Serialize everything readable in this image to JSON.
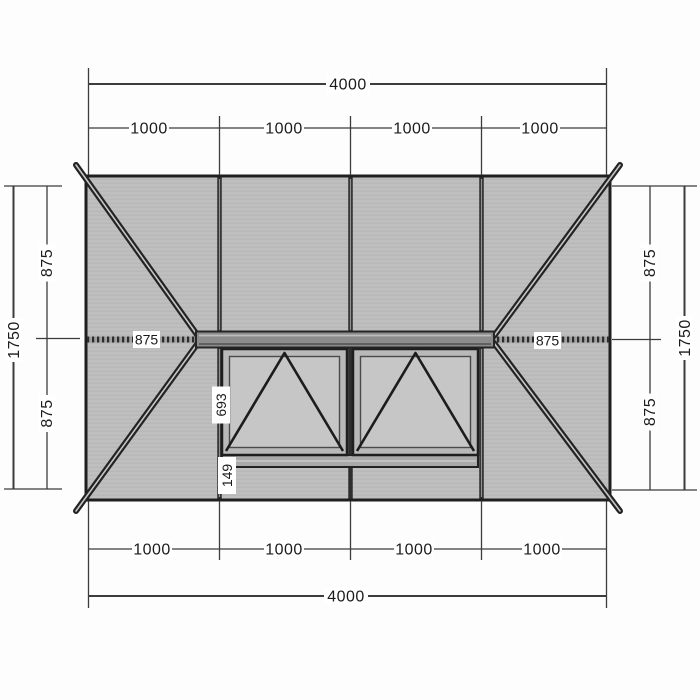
{
  "drawing": {
    "title": "roof-lantern-plan",
    "colors": {
      "roof_glass": "#bfbfbf",
      "roof_glass_line": "#b6b6b6",
      "vent_glass": "#c6c6c6",
      "vent_frame_fill": "#b9b9b9",
      "ridge_fill": "#8c8c8c",
      "sill_fill": "#a9a9a9",
      "outline_dark": "#1f1f1f",
      "dim_line": "#3c3c3c",
      "label_bg": "#ffffff"
    }
  },
  "dims": {
    "top": {
      "overall": "4000",
      "segments": [
        "1000",
        "1000",
        "1000",
        "1000"
      ]
    },
    "bottom": {
      "overall": "4000",
      "segments": [
        "1000",
        "1000",
        "1000",
        "1000"
      ]
    },
    "left": {
      "overall": "1750",
      "upper": "875",
      "lower": "875"
    },
    "right": {
      "overall": "1750",
      "upper": "875",
      "lower": "875"
    },
    "ridge": {
      "left_jack": "875",
      "right_jack": "875"
    },
    "vent": {
      "height": "693",
      "below": "149"
    }
  }
}
